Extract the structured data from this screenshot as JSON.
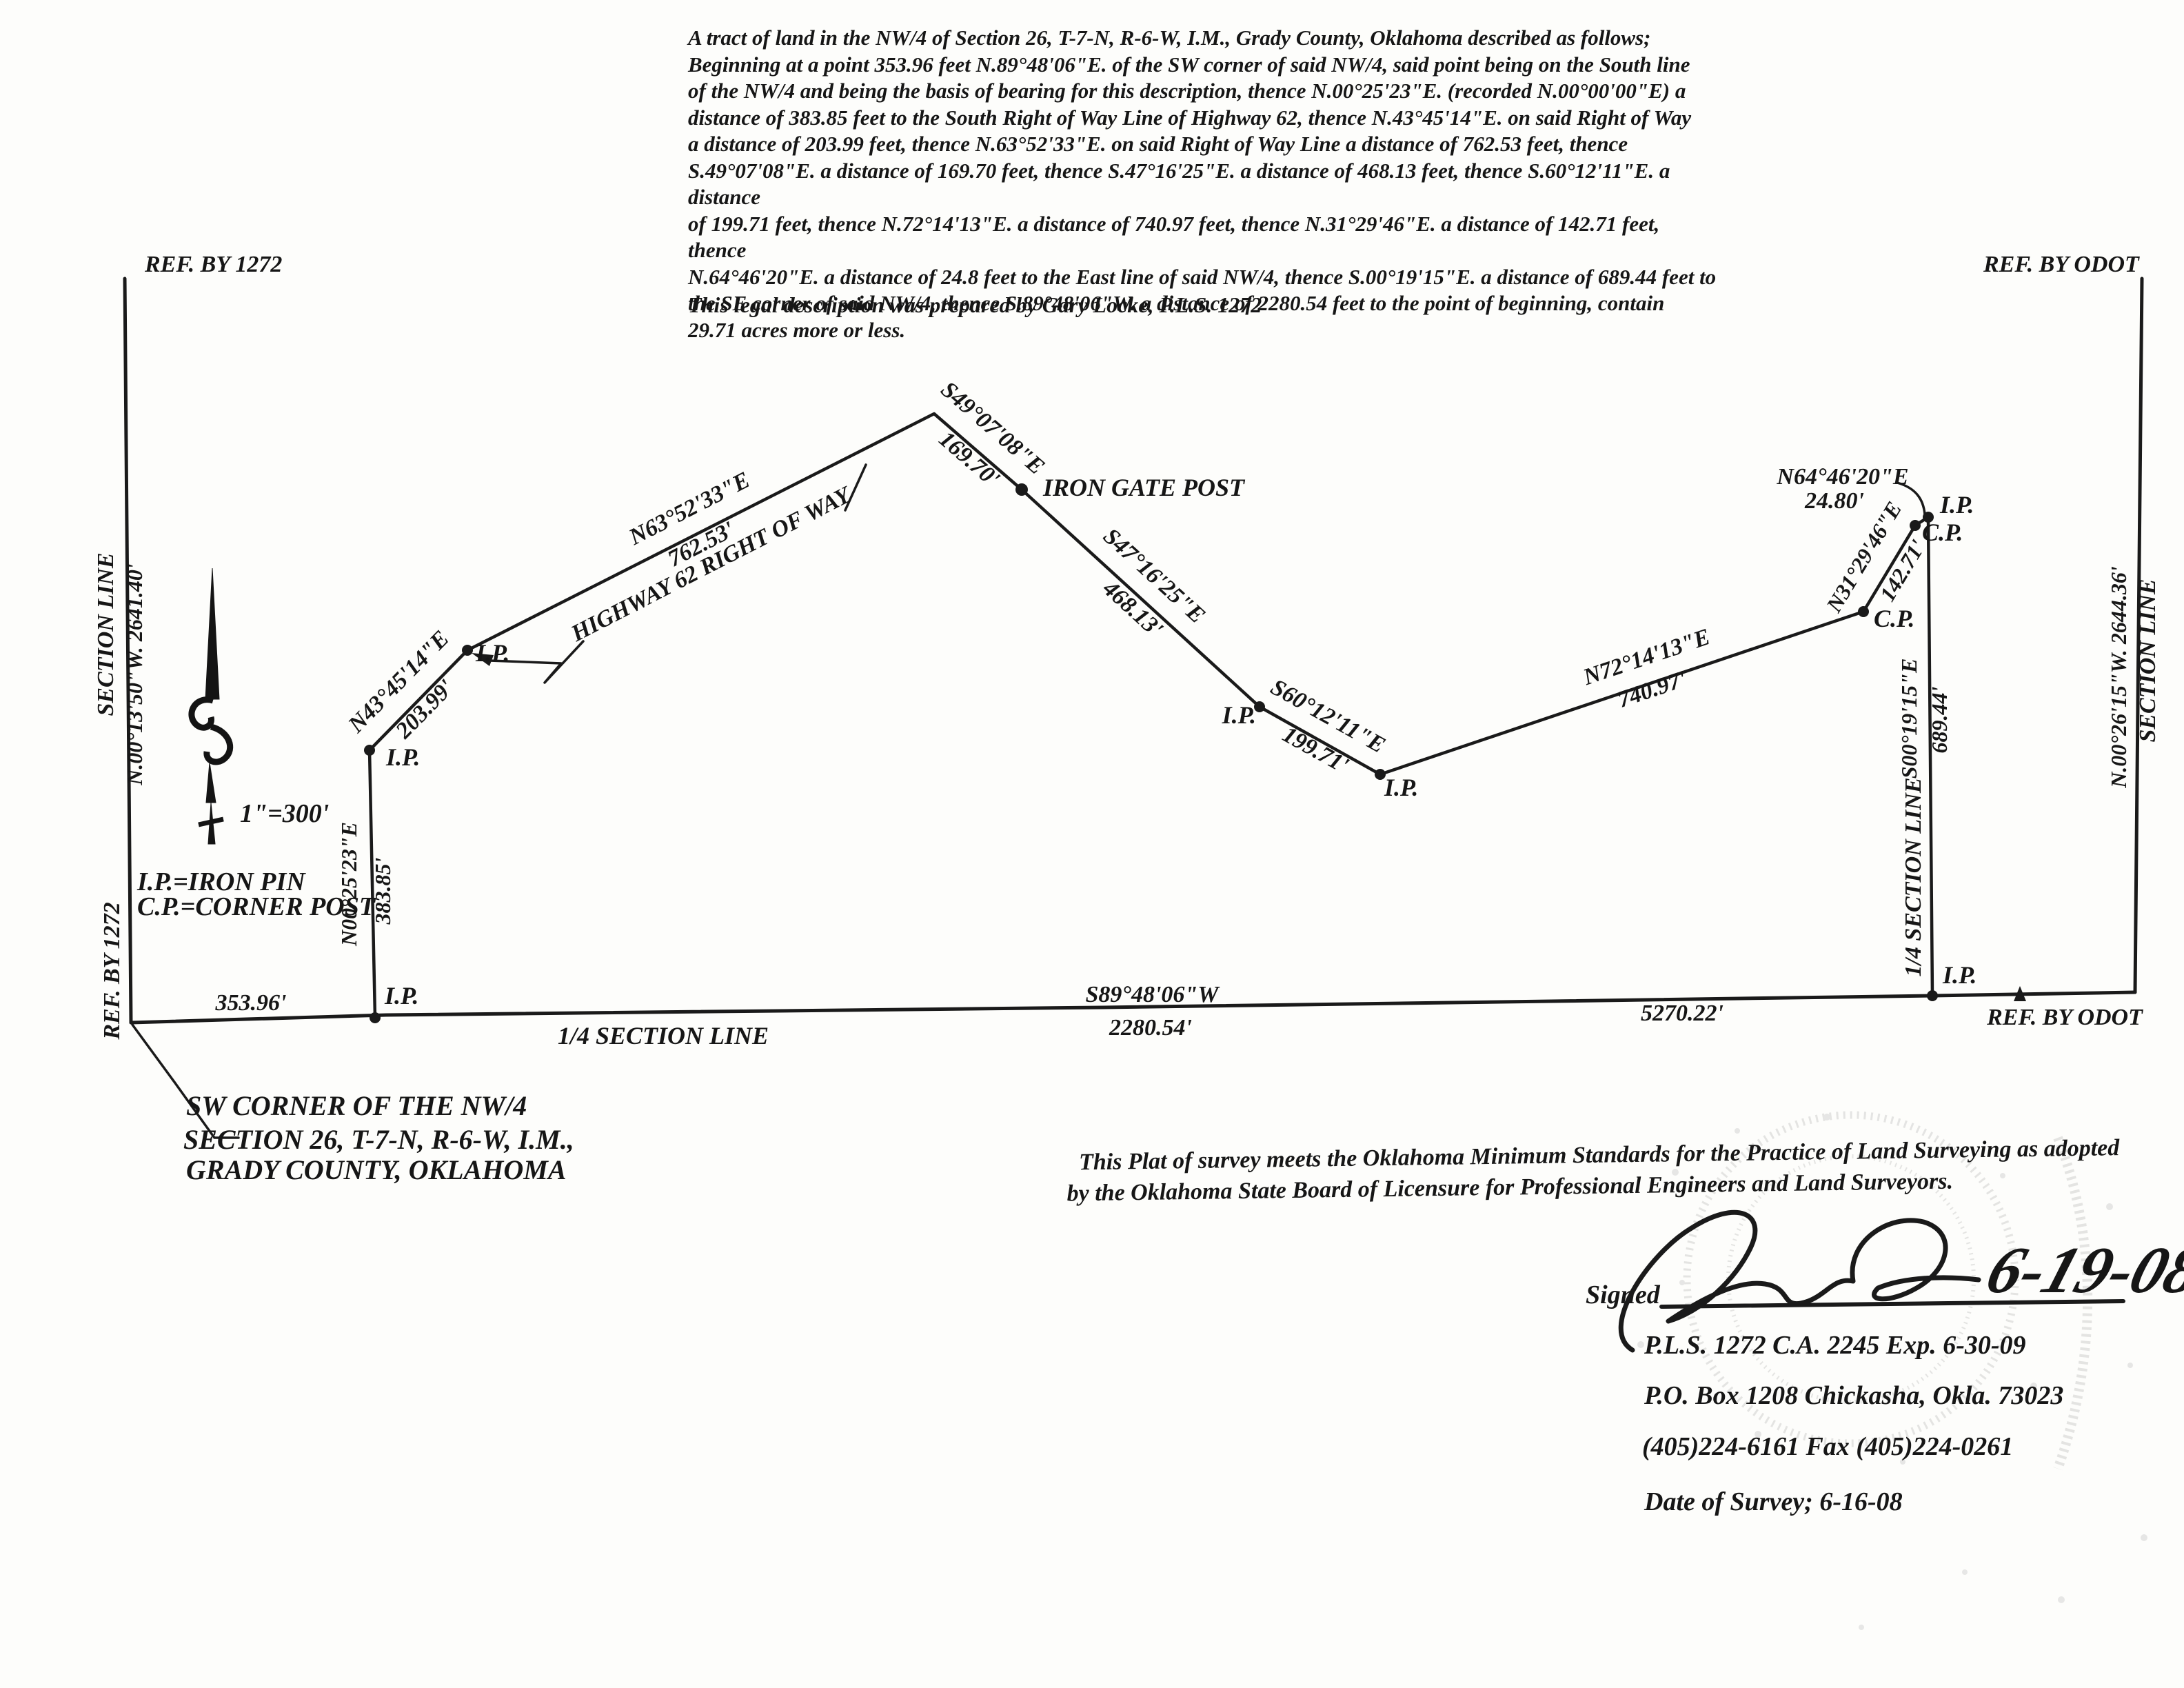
{
  "legal_description": {
    "lines": [
      "A tract of land in the NW/4 of Section 26, T-7-N, R-6-W, I.M., Grady County, Oklahoma described as follows;",
      "Beginning at a point 353.96 feet N.89°48'06\"E. of the SW corner of said NW/4, said point being on the South line",
      "of the NW/4 and being the basis of bearing for this description, thence N.00°25'23\"E. (recorded N.00°00'00\"E) a",
      "distance of 383.85 feet to the South Right of Way Line of Highway 62, thence N.43°45'14\"E. on said Right of Way",
      "a distance of 203.99 feet, thence N.63°52'33\"E. on said Right of Way Line a distance of 762.53 feet, thence",
      "S.49°07'08\"E. a distance of 169.70 feet, thence S.47°16'25\"E. a distance of 468.13 feet, thence S.60°12'11\"E. a distance",
      "of 199.71 feet, thence N.72°14'13\"E. a distance of 740.97 feet, thence N.31°29'46\"E. a distance of 142.71 feet, thence",
      "N.64°46'20\"E. a distance of 24.8 feet to the East line of said NW/4, thence S.00°19'15\"E. a distance of 689.44 feet to",
      "the SE corner of said NW/4, thence S.89°48'06\"W. a distance of 2280.54 feet to the point of beginning, contain",
      "29.71 acres more or less."
    ],
    "prepared_by": "This legal description was prepared by Gary Locke, P.L.S. 1272"
  },
  "refs": {
    "top_left": "REF. BY 1272",
    "top_right": "REF. BY ODOT",
    "bottom_left": "REF. BY 1272",
    "bottom_right": "REF. BY ODOT"
  },
  "west_boundary": {
    "name": "SECTION   LINE",
    "bearing_distance": "N.00°13'50\"W.    2641.40'"
  },
  "east_boundary": {
    "name": "SECTION   LINE",
    "bearing_distance": "N.00°26'15\"W.    2644.36'"
  },
  "scale": "1\"=300'",
  "legend": {
    "ip": "I.P.=IRON PIN",
    "cp": "C.P.=CORNER POST"
  },
  "markers": {
    "ip": "I.P.",
    "cp": "C.P."
  },
  "sw_corner_note": {
    "line1": "SW CORNER OF THE NW/4",
    "line2": "SECTION 26, T-7-N, R-6-W, I.M.,",
    "line3": "GRADY COUNTY, OKLAHOMA"
  },
  "south_line": {
    "offset": "353.96'",
    "quarter_label": "1/4   SECTION   LINE",
    "bearing": "S89°48'06\"W",
    "distance": "2280.54'",
    "remainder": "5270.22'"
  },
  "east_quarter_line": {
    "label": "1/4 SECTION LINE",
    "bearing": "S00°19'15\"E",
    "distance": "689.44'"
  },
  "courses": {
    "n00": {
      "bearing": "N00°25'23\"E",
      "distance": "383.85'"
    },
    "n43": {
      "bearing": "N43°45'14\"E",
      "distance": "203.99'"
    },
    "n63": {
      "bearing": "N63°52'33\"E",
      "distance": "762.53'"
    },
    "s49": {
      "bearing": "S49°07'08\"E",
      "distance": "169.70'"
    },
    "s47": {
      "bearing": "S47°16'25\"E",
      "distance": "468.13'"
    },
    "s60": {
      "bearing": "S60°12'11\"E",
      "distance": "199.71'"
    },
    "n72": {
      "bearing": "N72°14'13\"E",
      "distance": "740.97'"
    },
    "n31": {
      "bearing": "N31°29'46\"E",
      "distance": "142.71'"
    },
    "n64": {
      "bearing": "N64°46'20\"E",
      "distance": "24.80'"
    }
  },
  "features": {
    "highway": "HIGHWAY 62 RIGHT OF WAY",
    "iron_gate_post": "IRON GATE POST"
  },
  "certification": {
    "line1": "This Plat of survey meets the Oklahoma Minimum Standards for the Practice of Land Surveying as adopted",
    "line2": "by the Oklahoma State Board of Licensure for Professional Engineers and Land Surveyors."
  },
  "signature_block": {
    "signed_label": "Signed",
    "handwritten_date": "6-19-08",
    "license": "P.L.S. 1272 C.A. 2245 Exp. 6-30-09",
    "address": "P.O. Box 1208 Chickasha, Okla. 73023",
    "phone": "(405)224-6161 Fax (405)224-0261",
    "survey_date": "Date of Survey; 6-16-08"
  }
}
